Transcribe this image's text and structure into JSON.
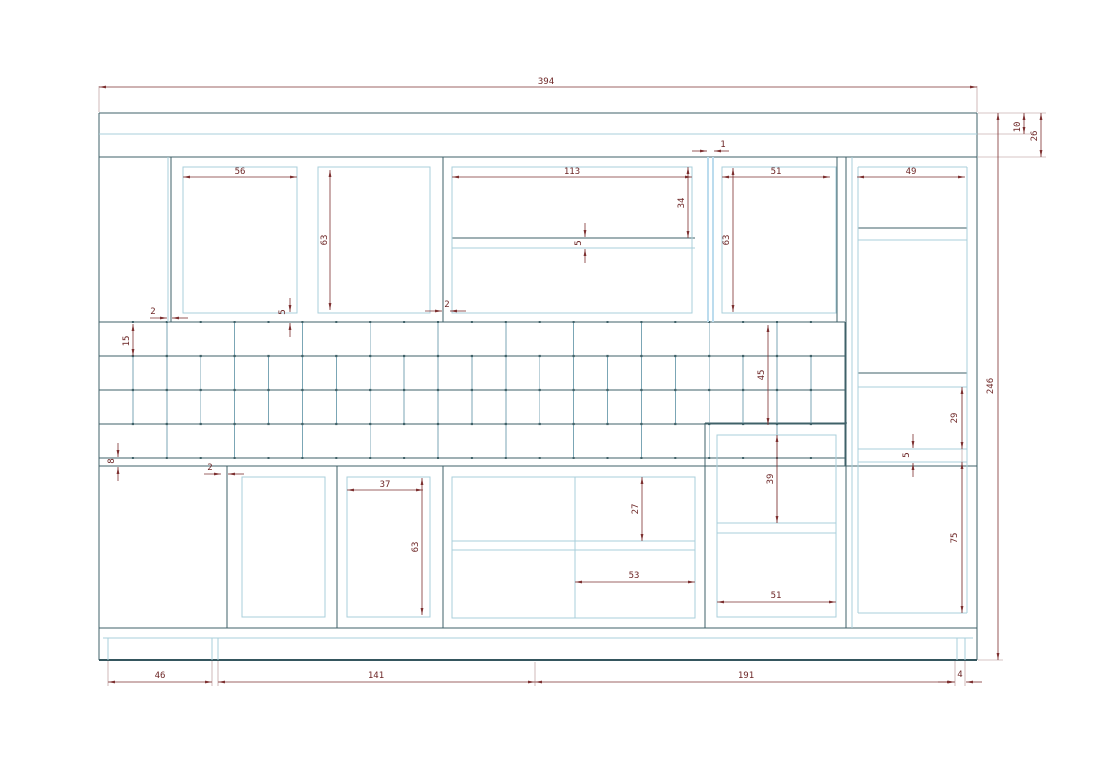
{
  "drawing": {
    "type": "cad-cabinet-elevation",
    "colors": {
      "structure_dark": "#3f6168",
      "panel_light_blue": "#a9cfdb",
      "center_stile_pale": "#bcdcee",
      "grid_line": "#7ba6b5",
      "dimension_red": "#7d3030"
    }
  },
  "dims": {
    "top_width": "394",
    "right_total_height": "246",
    "cornice_height": "10",
    "cornice_total": "26",
    "upper_box1_width": "56",
    "upper_stile_gap": "2",
    "upper_box2_height": "63",
    "upper_box2_gap": "5",
    "upper_box3_width": "113",
    "upper_box3_drop": "34",
    "upper_box3_shelf": "5",
    "upper_box3_gap": "2",
    "center_panel_gap": "1",
    "upper_box4_width": "51",
    "upper_box4_height": "63",
    "tall_cab_width": "49",
    "grid_row_height": "15",
    "grid_height": "45",
    "grid_base_gap": "8",
    "tall_shelf_gap": "29",
    "tall_shelf_thickness": "5",
    "tall_lower_height": "75",
    "lower_stile_gap": "2",
    "lower_box2_width": "37",
    "lower_box2_height": "63",
    "lower_box3_drawer": "27",
    "lower_box3_width": "53",
    "lower_box4_drawer": "39",
    "lower_box4_width": "51",
    "plinth_left": "46",
    "plinth_mid": "141",
    "plinth_right": "191",
    "plinth_end": "4"
  }
}
